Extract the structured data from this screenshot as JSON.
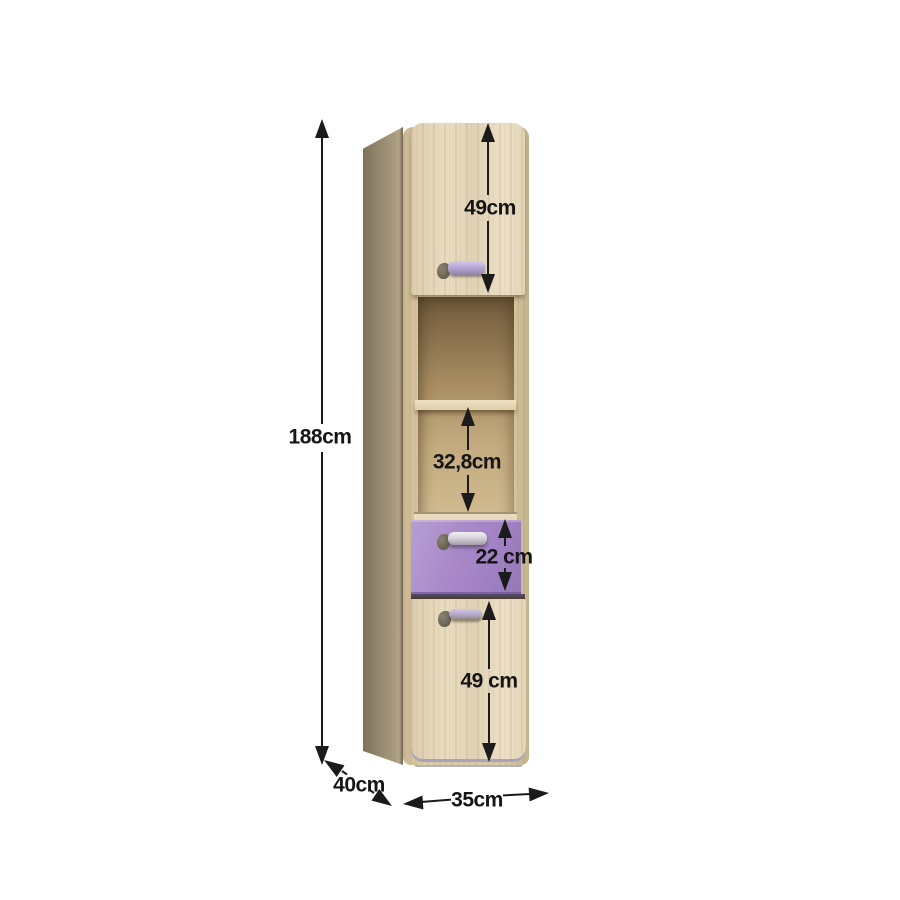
{
  "figure": {
    "title": "Tall cabinet dimension diagram",
    "colors": {
      "wood_front": "#e6d9bd",
      "wood_side": "#96886e",
      "accent_purple": "#a585c4",
      "handle_silver": "#d6d3db",
      "dimension_ink": "#1b1b1b",
      "background": "#ffffff"
    }
  },
  "dimensions": {
    "overall_height": "188cm",
    "top_door_height": "49cm",
    "open_shelf_height": "32,8cm",
    "drawer_height": "22 cm",
    "bottom_door_height": "49 cm",
    "depth": "40cm",
    "width": "35cm"
  }
}
